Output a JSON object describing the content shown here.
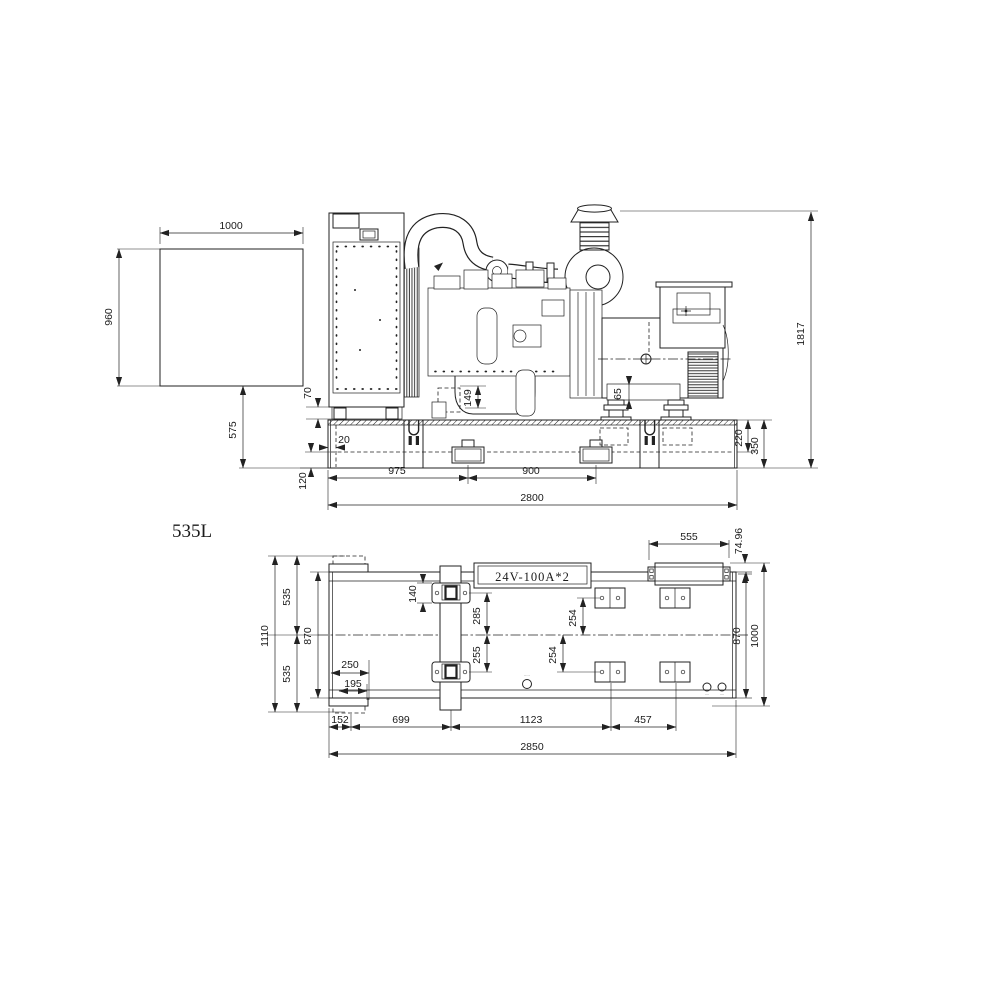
{
  "drawing": {
    "model_label": "535L",
    "battery_label": "24V-100A*2",
    "tiny_port_labels": {
      "center": "·····",
      "right_a": "····",
      "right_b": "····"
    },
    "line_color": "#222222",
    "background_color": "#ffffff"
  },
  "side_view": {
    "dims": {
      "duct_width": "1000",
      "duct_height": "960",
      "duct_to_base": "575",
      "radiator_gap": "70",
      "frame_inset": "20",
      "frame_lower": "120",
      "pocket_offset": "975",
      "pocket_pitch": "900",
      "base_length": "2800",
      "overall_height": "1817",
      "rail_upper": "220",
      "rail_height": "350",
      "oil_pan_height": "149",
      "alt_base_height": "65"
    }
  },
  "plan_view": {
    "dims": {
      "overall_width": "1110",
      "half_width_top": "535",
      "frame_width_left": "870",
      "half_width_bottom": "535",
      "pad_box_250": "250",
      "pad_box_195": "195",
      "seg_152": "152",
      "seg_699": "699",
      "seg_1123": "1123",
      "seg_457": "457",
      "base_length": "2850",
      "cross_pad_140": "140",
      "cross_pad_285": "285",
      "cross_pad_255": "255",
      "pad_254_upper": "254",
      "pad_254_lower": "254",
      "muffler_length": "555",
      "muffler_offset": "74.96",
      "frame_width_right": "870",
      "overall_width_right": "1000"
    }
  }
}
